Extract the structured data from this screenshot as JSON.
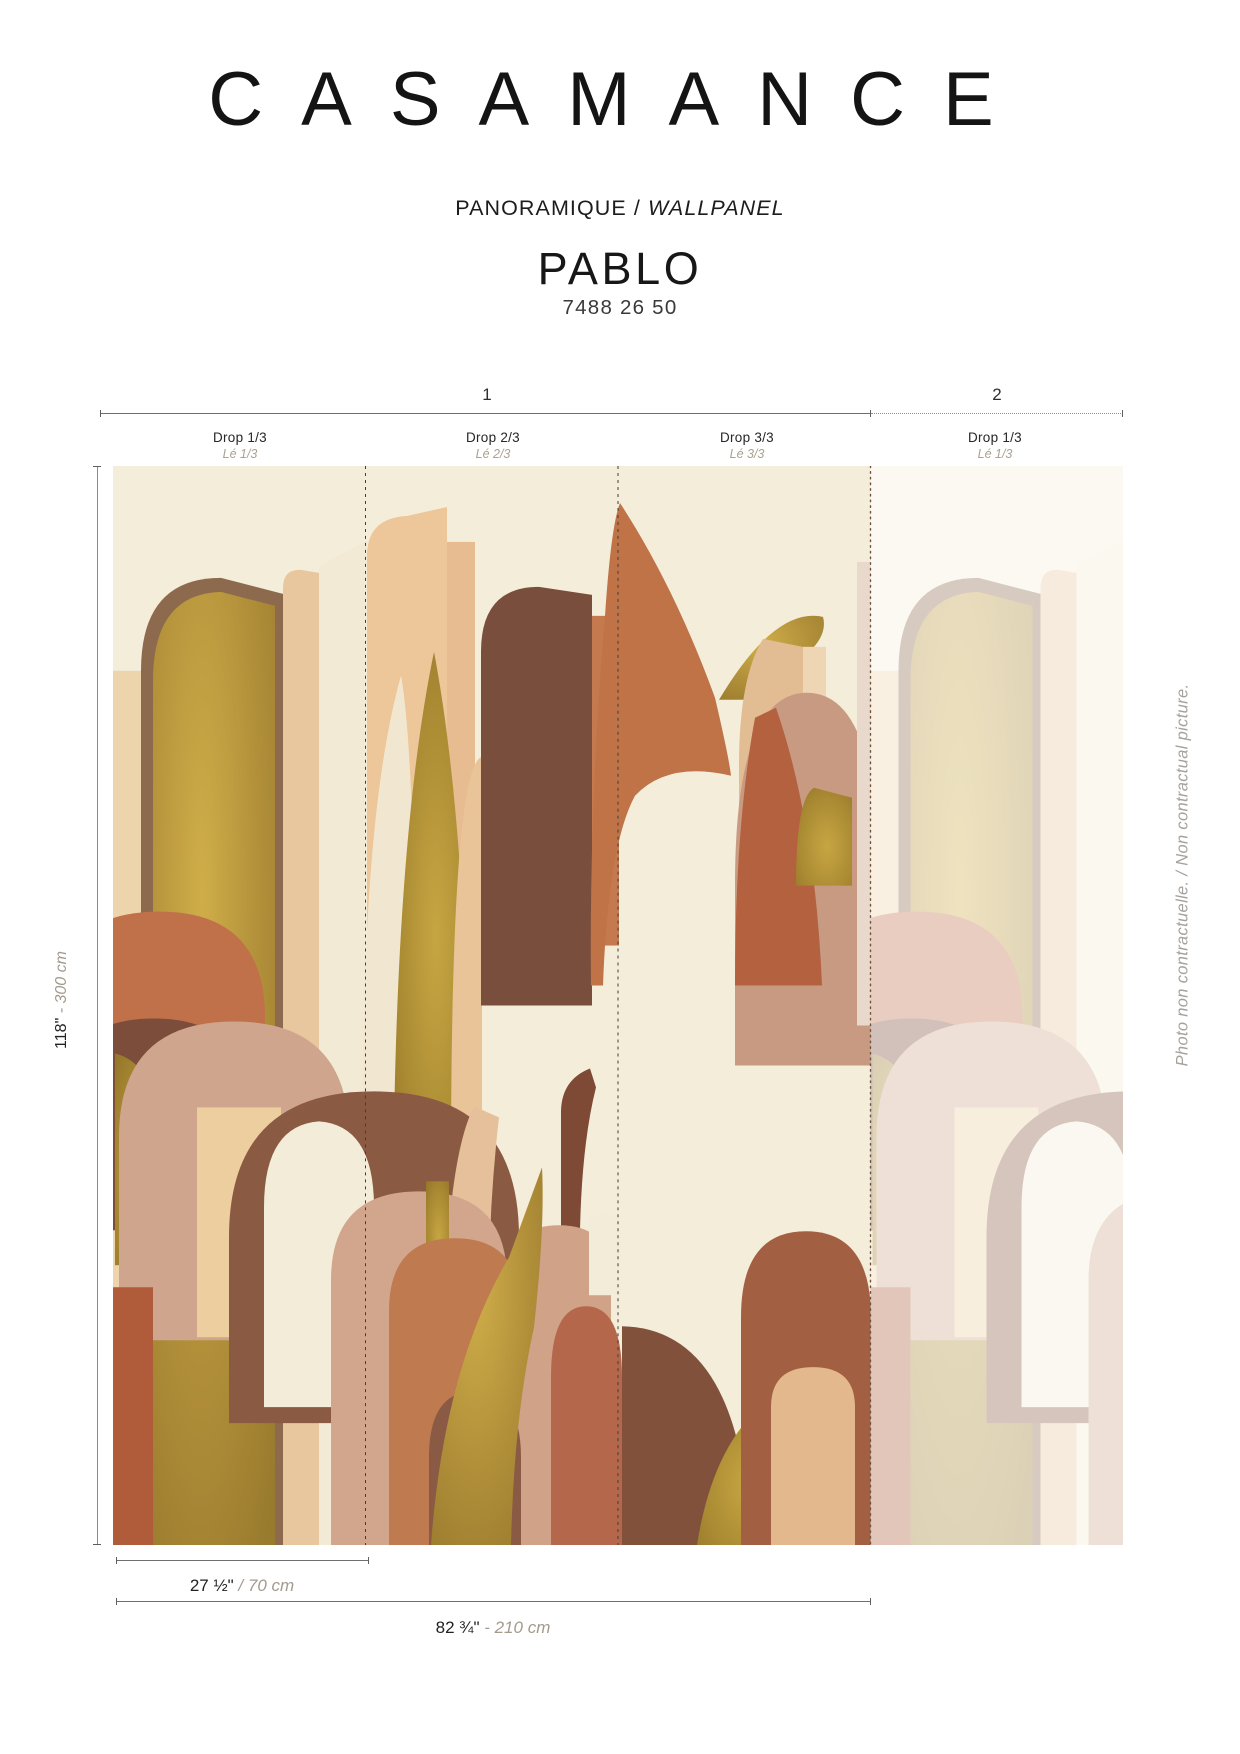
{
  "header": {
    "brand": "CASAMANCE",
    "category_fr": "PANORAMIQUE / ",
    "category_en": "WALLPANEL",
    "product_name": "PABLO",
    "reference": "7488 26 50"
  },
  "diagram": {
    "panel_1_label": "1",
    "panel_2_label": "2",
    "drops": [
      {
        "en": "Drop 1/3",
        "fr": "Lé 1/3"
      },
      {
        "en": "Drop 2/3",
        "fr": "Lé 2/3"
      },
      {
        "en": "Drop 3/3",
        "fr": "Lé 3/3"
      },
      {
        "en": "Drop 1/3",
        "fr": "Lé 1/3"
      }
    ],
    "height": {
      "imperial": "118\"",
      "metric": " - 300 cm"
    },
    "drop_width": {
      "imperial": "27 ½\"",
      "metric": " / 70 cm"
    },
    "panel_width": {
      "imperial": "82 ¾\"",
      "metric": " - 210 cm"
    }
  },
  "footnote": {
    "text": "Photo non contractuelle. / Non contractual picture."
  },
  "colors": {
    "ink": "#1a1a1a",
    "muted_label": "#aba290",
    "dim_line": "#6f6f6f",
    "art": {
      "cream": "#f4edda",
      "cream_light": "#f3ecd9",
      "tan": "#e8c79e",
      "peach": "#edc699",
      "rose": "#cfa68d",
      "pale_rose": "#e9d8cc",
      "terracotta": "#c0714a",
      "rust": "#b4674a",
      "brown": "#8a5a42",
      "dark_brown": "#7a4e3c",
      "gold": "#b2903a"
    }
  }
}
